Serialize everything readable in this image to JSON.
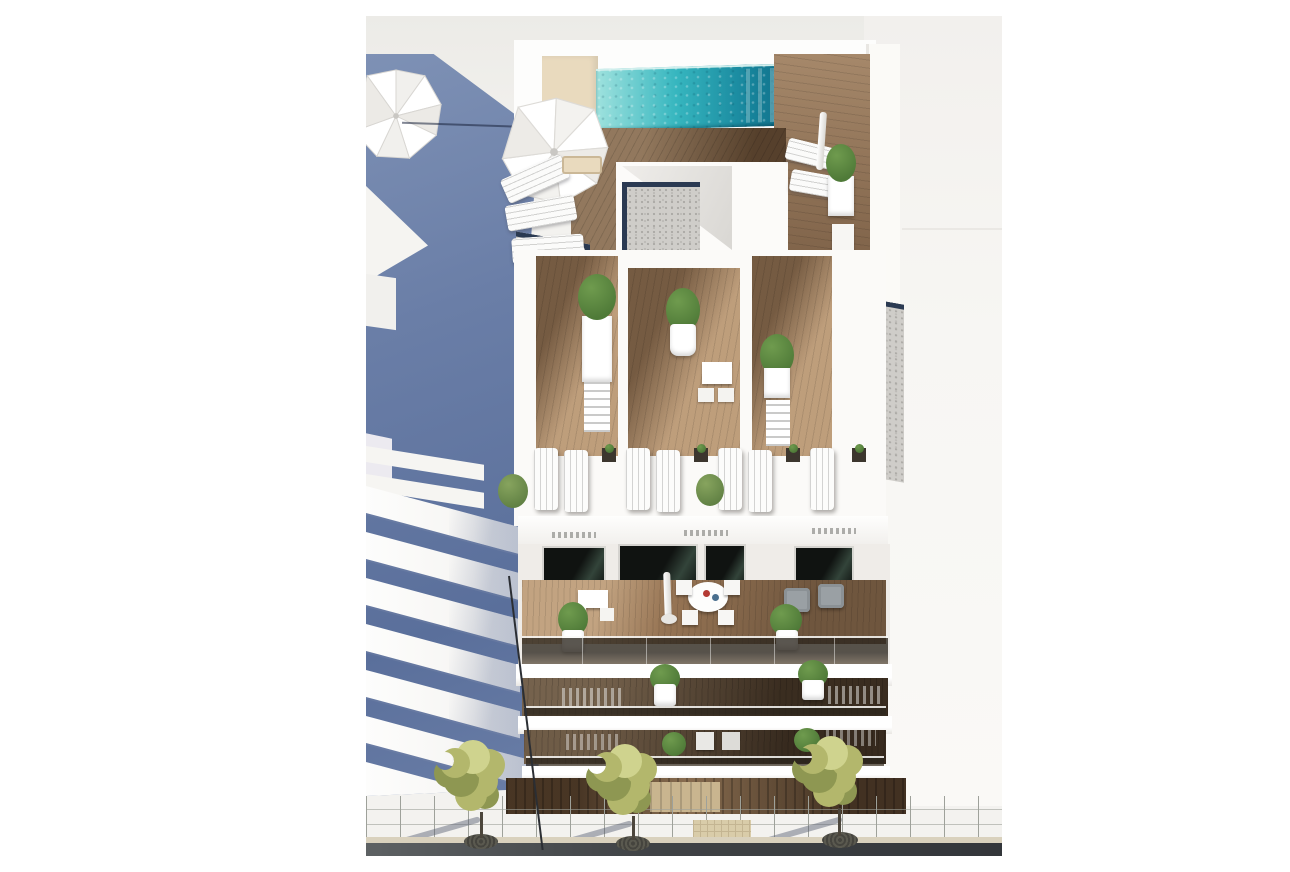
{
  "meta": {
    "title": "Aerial 3D render of a new-build apartment block",
    "description": "High-angle architectural rendering of a modern white apartment building with a turquoise rooftop lap pool, white parasols and sun loungers on wooden roof terraces, gravel roof sections, three mid-level terraces with lounger pairs and potted plants, furnished balconies with glass balustrades, a dark timber-clad ground floor, and a grey paved sidewalk with three street trees in front. A neighbouring building stands in blue shadow on the left.",
    "visible_text": "none"
  },
  "colors": {
    "margin": "#ffffff",
    "bg_top": "#ecebe7",
    "bg_main": "#f3f2ef",
    "blue": "#6a7ea7",
    "blue_dark": "#5a6f9b",
    "blue_light": "#7e91b5",
    "white_wall": "#fdfdfc",
    "pool_light": "#9fe2de",
    "pool_mid": "#36b6bf",
    "pool_deep": "#17859c",
    "pool_dark": "#0e647f",
    "deck_beige": "#e9dabe",
    "wood_light": "#a8825e",
    "wood_mid": "#8d6b4d",
    "wood_dark": "#6e5238",
    "wood_deep": "#53402e",
    "gravel": "#cfcdc9",
    "gravel_dot": "#a9a7a3",
    "navy": "#2b3a52",
    "window": "#101311",
    "window_green": "#33443a",
    "pavement": "#b6b9b1",
    "pavement_line": "#9ea19a",
    "road": "#3f4245",
    "curb": "#d9d1bd",
    "foliage": "#b3b76c",
    "foliage_dark": "#8e9752",
    "foliage_light": "#cfd38e",
    "grate": "#45443e",
    "mat": "#d9cca9",
    "green": "#6f9b4e",
    "green_dark": "#4f7a38",
    "pot": "#ffffff",
    "grey_chair": "#9aa0a4",
    "shadow": "rgba(84,92,110,0.45)"
  },
  "scene": {
    "neighbor_building": {
      "label": "adjacent building in blue shadow",
      "sunlit_balcony_slabs": 7,
      "parasol": 1
    },
    "rooftop": {
      "pool": "turquoise lap pool",
      "parasols": 2,
      "loungers": 5,
      "planters": 2,
      "gravel_roof_sections": 5,
      "decking": "wood and beige stone"
    },
    "mid_terraces": {
      "terraces": 3,
      "lounger_pairs": 4,
      "side_tables": 3,
      "bistro_sets": 1,
      "potted_plants": 6
    },
    "main_balcony": {
      "round_table_seats": 4,
      "square_table_seats": 2,
      "armchairs": 2,
      "closed_parasol": 1,
      "potted_plants": 2,
      "balustrade": "glass"
    },
    "lower_balconies": {
      "rows": 2,
      "potted_plants": 4,
      "chairs": 2
    },
    "ground_floor": {
      "cladding": "dark timber",
      "entrance_door": 1
    },
    "street": {
      "trees": 3,
      "tree_grates": 3,
      "pavement": "grey stone pavers",
      "tactile_mat": 1,
      "road": "asphalt",
      "lamp_post": 1
    }
  }
}
